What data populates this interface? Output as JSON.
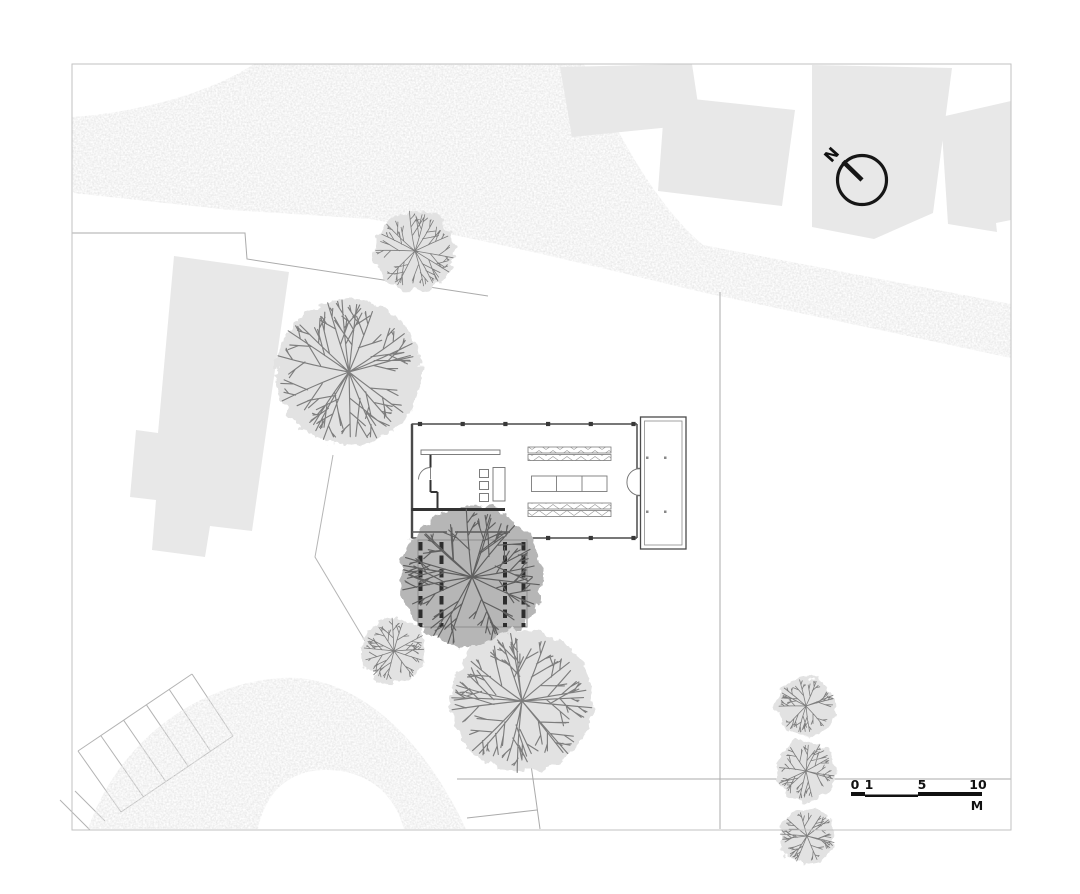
{
  "compass": {
    "icon": "north-arrow-icon",
    "label": "N"
  },
  "scale_bar": {
    "tick_labels": [
      "0",
      "1",
      "5",
      "10"
    ],
    "unit_label": "M"
  },
  "colors": {
    "page_bg": "#ffffff",
    "road_fill": "#d6d6d6",
    "context_building_fill": "#e8e8e8",
    "plan_line": "#4a4a4a",
    "plan_wall_dark": "#333333",
    "boundary_line": "#ababab",
    "border_line": "#c2c2c2",
    "compass_ink": "#161616",
    "tree_light_fill": "#e2e2e2",
    "tree_light_branch": "#7d7d7d",
    "tree_dark_fill": "#b6b6b6",
    "tree_dark_branch": "#5f5f5f",
    "pergola_slat": "#2d2d2d"
  },
  "trees": [
    {
      "cx": 415,
      "cy": 251,
      "r": 42,
      "shade": "light",
      "seed": 11
    },
    {
      "cx": 349,
      "cy": 372,
      "r": 76,
      "shade": "light",
      "seed": 22
    },
    {
      "cx": 394,
      "cy": 651,
      "r": 34,
      "shade": "light",
      "seed": 44
    },
    {
      "cx": 522,
      "cy": 701,
      "r": 74,
      "shade": "light",
      "seed": 55
    },
    {
      "cx": 806,
      "cy": 706,
      "r": 31,
      "shade": "light",
      "seed": 66
    },
    {
      "cx": 806,
      "cy": 771,
      "r": 31,
      "shade": "light",
      "seed": 77
    },
    {
      "cx": 807,
      "cy": 836,
      "r": 29,
      "shade": "light",
      "seed": 88
    }
  ],
  "courtyard_tree": {
    "cx": 472,
    "cy": 577,
    "r": 74,
    "shade": "dark",
    "seed": 33
  }
}
